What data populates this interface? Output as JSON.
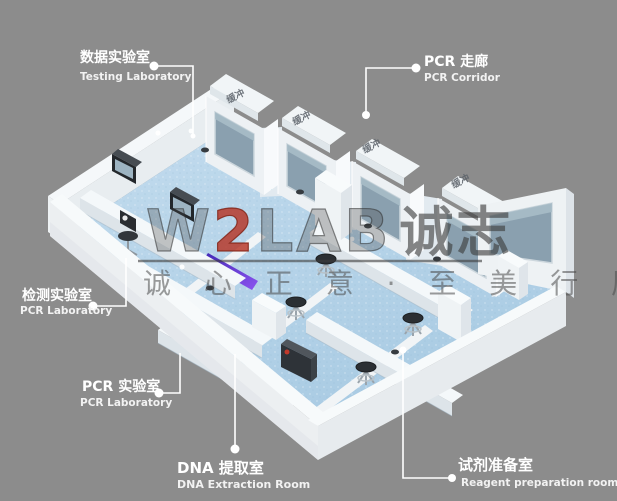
{
  "watermark": {
    "w": "W",
    "two": "2",
    "lab": "LAB",
    "cn": "诚志",
    "slogan": "诚 心 正 意 · 至 美 行 厉"
  },
  "buffers": [
    {
      "label": "缓冲"
    },
    {
      "label": "缓冲"
    },
    {
      "label": "缓冲"
    },
    {
      "label": "缓冲"
    }
  ],
  "rooms": [
    {
      "cn": "数据实验室",
      "en": "Testing Laboratory"
    },
    {
      "cn": "PCR 走廊",
      "en": "PCR Corridor"
    },
    {
      "cn": "检测实验室",
      "en": "PCR Laboratory"
    },
    {
      "cn": "PCR 实验室",
      "en": "PCR Laboratory"
    },
    {
      "cn": "DNA 提取室",
      "en": "DNA Extraction Room"
    },
    {
      "cn": "试剂准备室",
      "en": "Reagent preparation room"
    }
  ],
  "colors": {
    "background": "#8c8c8c",
    "floor_blue": "#b7d4e9",
    "wall_white": "#eef2f4",
    "window_gray": "#8aa0af",
    "uv_purple": "#5b2fd4",
    "watermark_red": "#b5301f"
  }
}
